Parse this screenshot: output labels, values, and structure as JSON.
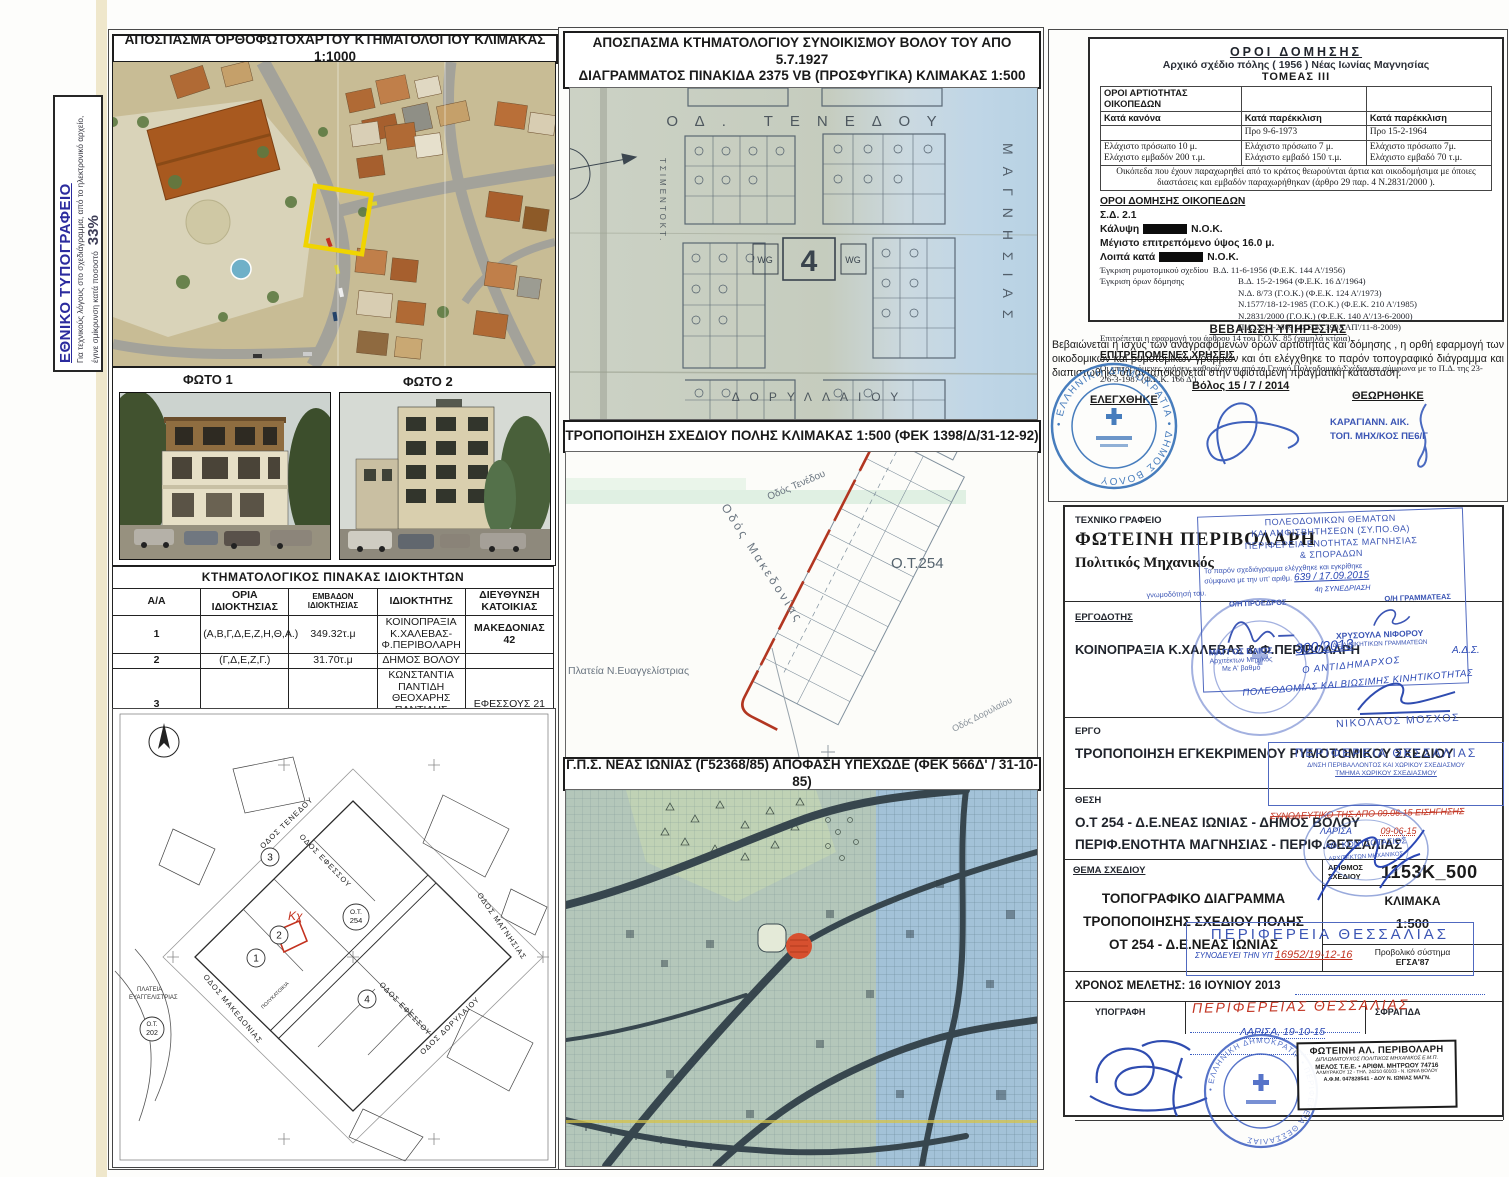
{
  "note_box": {
    "title": "ΕΘΝΙΚΟ ΤΥΠΟΓΡΑΦΕΙΟ",
    "body": "Για τεχνικούς λόγους στο σχεδιάγραμμα, από το ηλεκτρονικό αρχείο, έγινε σμίκρυνση κατά ποσοστό",
    "percent": "33%"
  },
  "ortho": {
    "title": "ΑΠΟΣΠΑΣΜΑ ΟΡΘΟΦΩΤΟΧΑΡΤΟΥ ΚΤΗΜΑΤΟΛΟΓΙΟΥ ΚΛΙΜΑΚΑΣ 1:1000"
  },
  "photos": {
    "label1": "ΦΩΤΟ 1",
    "label2": "ΦΩΤΟ 2"
  },
  "owners_table": {
    "title": "ΚΤΗΜΑΤΟΛΟΓΙΚΟΣ ΠΙΝΑΚΑΣ ΙΔΙΟΚΤΗΤΩΝ",
    "headers": [
      "Α/Α",
      "ΟΡΙΑ ΙΔΙΟΚΤΗΣΙΑΣ",
      "ΕΜΒΑΔΟΝ ΙΔΙΟΚΤΗΣΙΑΣ",
      "ΙΔΙΟΚΤΗΤΗΣ",
      "ΔΙΕΥΘΥΝΣΗ ΚΑΤΟΙΚΙΑΣ"
    ],
    "rows": [
      {
        "aa": "1",
        "oria": "(Α,Β,Γ,Δ,Ε,Ζ,Η,Θ,Α.)",
        "emvadon": "349.32τ.μ",
        "owner1": "ΚΟΙΝΟΠΡΑΞΙΑ Κ.ΧΑΛΕΒΑΣ-Φ.ΠΕΡΙΒΟΛΑΡΗ",
        "address": "ΜΑΚΕΔΟΝΙΑΣ 42"
      },
      {
        "aa": "2",
        "oria": "(Γ,Δ,Ε,Ζ,Γ.)",
        "emvadon": "31.70τ.μ",
        "owner1": "ΔΗΜΟΣ ΒΟΛΟΥ",
        "address": ""
      },
      {
        "aa": "3",
        "oria": "",
        "emvadon": "",
        "owner1": "ΚΩΝΣΤΑΝΤΙΑ ΠΑΝΤΙΔΗ",
        "owner2": "ΘΕΟΧΑΡΗΣ ΠΑΝΤΙΔΗΣ",
        "owner3": "ΑΠΟΣΤΟΛΟΣ ΠΑΝΤΙΔΗΣ",
        "address": "ΕΦΕΣΣΟΥΣ 21"
      },
      {
        "aa": "4",
        "oria": "",
        "emvadon": "",
        "owner1": "ΚΩΝΣΤΑΝΤΙΝΟΣ ΝΤΟΝΤΟΣ",
        "address": "ΕΦΕΣΣΟΥ 15"
      }
    ]
  },
  "map1927": {
    "title_line1": "ΑΠΟΣΠΑΣΜΑ ΚΤΗΜΑΤΟΛΟΓΙΟΥ ΣΥΝΟΙΚΙΣΜΟΥ ΒΟΛΟΥ ΤΟΥ ΑΠΟ 5.7.1927",
    "title_line2": "ΔΙΑΓΡΑΜΜΑΤΟΣ  ΠΙΝΑΚΙΔΑ 2375 VB (ΠΡΟΣΦΥΓΙΚΑ) ΚΛΙΜΑΚΑΣ 1:500",
    "street_top": "ΟΔ. ΤΕΝΕΔΟΥ",
    "street_bottom": "ΔΟΡΥΛΛΑΙΟΥ",
    "street_left": "ΤΣΙΜΕΝΤΟΚΤ.",
    "street_right": "ΜΑΓΝΗΣΙΑΣ",
    "block_number": "4",
    "wg_left": "WG",
    "wg_right": "WG"
  },
  "trop_map": {
    "title": "ΤΡΟΠΟΠΟΙΗΣΗ ΣΧΕΔΙΟΥ ΠΟΛΗΣ ΚΛΙΜΑΚΑΣ 1:500 (ΦΕΚ 1398/Δ/31-12-92)",
    "ot_label": "Ο.Τ.254",
    "street_makedonias": "Οδός Μακεδονίας",
    "street_tenedou": "Οδός Τενέδου",
    "street_dorylaiou": "Οδός Δορυλαίου",
    "plateia": "Πλατεία Ν.Ευαγγελίστριας"
  },
  "gps_map": {
    "title": "Γ.Π.Σ. ΝΕΑΣ ΙΩΝΙΑΣ (Γ52368/85) ΑΠΟΦΑΣΗ ΥΠΕΧΩΔΕ (ΦΕΚ 566Δ' / 31-10-85)"
  },
  "site_plan": {
    "ot_center_l1": "Ο.Τ.",
    "ot_center_l2": "254",
    "ot_left_l1": "Ο.Τ.",
    "ot_left_l2": "202",
    "kx": "Κχ",
    "parcel1": "1",
    "parcel2": "2",
    "parcel3": "3",
    "parcel4": "4",
    "street_tenedou": "ΟΔΟΣ ΤΕΝΕΔΟΥ",
    "street_makedonias": "ΟΔΟΣ ΜΑΚΕΔΟΝΙΑΣ",
    "street_efessou": "ΟΔΟΣ ΕΦΕΣΣΟΥ",
    "street_efessou2": "ΟΔΟΣ ΕΦΕΣΣΟΥ",
    "street_dorylaiou": "ΟΔΟΣ ΔΟΡΥΛΑΙΟΥ",
    "street_magnisias": "ΟΔΟΣ ΜΑΓΝΗΣΙΑΣ",
    "polykatoikia": "ΠΟΛΥΚΑΤΟΙΚΙΑ",
    "plateia_l1": "ΠΛΑΤΕΙΑ",
    "plateia_l2": "ΕΥΑΓΓΕΛΙΣΤΡΙΑΣ"
  },
  "oroi": {
    "title": "ΟΡΟΙ  ΔΟΜΗΣΗΣ",
    "subtitle": "Αρχικό σχέδιο πόλης  ( 1956 )  Νέας Ιωνίας Μαγνησίας",
    "tomeas": "ΤΟΜΕΑΣ  III",
    "artiotita_header": "ΟΡΟΙ ΑΡΤΙΟΤΗΤΑΣ ΟΙΚΟΠΕΔΩΝ",
    "col_kanona": "Κατά κανόνα",
    "col_parekklisi1": "Κατά παρέκκλιση",
    "col_parekklisi2": "Κατά παρέκκλιση",
    "pro1": "Προ 9-6-1973",
    "pro2": "Προ 15-2-1964",
    "kanona_line1": "Ελάχιστο πρόσωπο  10 μ.",
    "kanona_line2": "Ελάχιστο εμβαδόν  200 τ.μ.",
    "par1_line1": "Ελάχιστο πρόσωπο 7 μ.",
    "par1_line2": "Ελάχιστο εμβαδό  150 τ.μ.",
    "par2_line1": "Ελάχιστο πρόσωπο  7μ.",
    "par2_line2": "Ελάχιστο εμβαδό 70  τ.μ.",
    "note": "Οικόπεδα που έχουν παραχωρηθεί από το κράτος θεωρούνται άρτια και οικοδομήσιμα με όποιες διαστάσεις  και  εμβαδόν  παραχωρήθηκαν  (άρθρο 29 παρ. 4 Ν.2831/2000 ).",
    "section2": "ΟΡΟΙ  ΔΟΜΗΣΗΣ ΟΙΚΟΠΕΔΩΝ",
    "sd": "Σ.Δ.    2.1",
    "kalypsi_label": "Κάλυψη",
    "kalypsi_suffix": "Ν.Ο.Κ.",
    "ypsos": "Μέγιστο επιτρεπόμενο ύψος  16.0 μ.",
    "loipa_label": "Λοιπά κατά",
    "loipa_suffix": "Ν.Ο.Κ.",
    "egkrisi1_label": "Έγκριση ρυμοτομικού σχεδίου",
    "egkrisi1_value": "Β.Δ. 11-6-1956    (Φ.Ε.Κ. 144 Α'/1956)",
    "egkrisi2_label": "Έγκριση όρων δόμησης",
    "egkrisi2_values": [
      "Β.Δ. 15-2-1964    (Φ.Ε.Κ.   16 Δ'/1964)",
      "Ν.Δ. 8/73 (Γ.Ο.Κ.)  (Φ.Ε.Κ. 124 Α'/1973)",
      "Ν.1577/18-12-1985 (Γ.Ο.Κ.)  (Φ.Ε.Κ. 210 Α'/1985)",
      "Ν.2831/2000 (Γ.Ο.Κ.)  (Φ.Ε.Κ. 140 Α'/13-6-2000)",
      "Π.Δ. 22-7-2009  (Φ.Ε.Κ. 390ΑΑΠ'/11-8-2009)"
    ],
    "note2": "Επιτρέπεται η εφαρμογή του άρθρου 14 του Γ.Ο.Κ. 85 (χαμηλά κτίρια)",
    "section3": "ΕΠΙΤΡΕΠΟΜΕΝΕΣ ΧΡΗΣΕΙΣ",
    "uses": "Οι επιτρεπόμενες χρήσεις καθορίζονται από το Γενικό Πολεοδομικό Σχέδιο και σύμφωνα με το Π.Δ. της 23-2/6-3-1987 (Φ.Ε.Κ. 166 Δ')."
  },
  "bebaiosi": {
    "title": "ΒΕΒΑΙΩΣΗ ΥΠΗΡΕΣΙΑΣ",
    "body": "Βεβαιώνεται η ισχύς των αναγραφόμενων όρων αρτιότητας και δόμησης , η ορθή εφαρμογή των οικοδομικών και ρυμοτομικών γραμμών και ότι ελέγχθηκε το παρόν τοπογραφικό διάγραμμα και διαπιστώθηκε ότι ανταποκρίνεται στην υφιστάμενη πραγματική κατάσταση.",
    "place_date": "Βόλος 15 / 7 / 2014",
    "checked": "ΕΛΕΓΧΘΗΚΕ",
    "approved": "ΘΕΩΡΗΘΗΚΕ",
    "approver_line1": "ΚΑΡΑΓΙΑΝΝ.  ΑΙΚ.",
    "approver_line2": "ΤΟΠ. ΜΗΧ/ΚΟΣ ΠΕ6/Γ",
    "dimos_stamp_ring": "• ΕΛΛΗΝΙΚΗ ΔΗΜΟΚΡΑΤΙΑ • ΔΗΜΟΣ ΒΟΛΟΥ"
  },
  "title_block": {
    "office_label": "ΤΕΧΝΙΚΟ  ΓΡΑΦΕΙΟ",
    "office_name": "ΦΩΤΕΙΝΗ ΠΕΡΙΒΟΛΑΡΗ",
    "office_role": "Πολιτικός Μηχανικός",
    "ergodotis_label": "ΕΡΓΟΔΟΤΗΣ",
    "ergodotis": "ΚΟΙΝΟΠΡΑΞΙΑ Κ.ΧΑΛΕΒΑΣ & Φ.ΠΕΡΙΒΟΛΑΡΗ",
    "ergo_label": "ΕΡΓΟ",
    "ergo": "ΤΡΟΠΟΠΟΙΗΣΗ ΕΓΚΕΚΡΙΜΕΝΟΥ ΡΥΜΟΤΟΜΙΚΟΥ ΣΧΕΔΙΟΥ",
    "thesi_label": "ΘΕΣΗ",
    "thesi_line1": "Ο.Τ 254 - Δ.Ε.ΝΕΑΣ ΙΩΝΙΑΣ - ΔΗΜΟΣ ΒΟΛΟΥ",
    "thesi_line2": "ΠΕΡΙΦ.ΕΝΟΤΗΤΑ ΜΑΓΝΗΣΙΑΣ - ΠΕΡΙΦ.ΘΕΣΣΑΛΙΑΣ",
    "thema_label": "ΘΕΜΑ ΣΧΕΔΙΟΥ",
    "thema_line1": "ΤΟΠΟΓΡΑΦΙΚΟ ΔΙΑΓΡΑΜΜΑ",
    "thema_line2": "ΤΡΟΠΟΠΟΙΗΣΗΣ ΣΧΕΔΙΟΥ ΠΟΛΗΣ",
    "thema_line3": "ΟΤ 254 - Δ.Ε.ΝΕΑΣ ΙΩΝΙΑΣ",
    "arithmos_label": "ΑΡΙΘΜΟΣ ΣΧΕΔΙΟΥ",
    "arithmos": "1153Κ_500",
    "klimaka_label": "ΚΛΙΜΑΚΑ",
    "klimaka": "1:500",
    "provoliko_label": "Προβολικό σύστημα",
    "provoliko": "ΕΓΣΑ'87",
    "xronos": "ΧΡΟΝΟΣ ΜΕΛΕΤΗΣ: 16 ΙΟΥΝΙΟΥ 2013",
    "ypografi_label": "ΥΠΟΓΡΑΦΗ",
    "sfragida_label": "ΣΦΡΑΓΙΔΑ"
  },
  "stamps": {
    "sypotha": {
      "line1": "ΠΟΛΕΟΔΟΜΙΚΩΝ ΘΕΜΑΤΩΝ",
      "line2": "ΚΑΙ ΑΜΦΙΣΒΗΤΗΣΕΩΝ (ΣΥ.ΠΟ.ΘΑ)",
      "line3": "ΠΕΡΙΦΕΡΕΙΑ ΕΝΟΤΗΤΑΣ ΜΑΓΝΗΣΙΑΣ",
      "line4": "& ΣΠΟΡΑΔΩΝ",
      "body1": "Το παρόν σχεδιάγραμμα ελέγχθηκε και εγκρίθηκε",
      "body2": "σύμφωνα με την υπ' αριθμ.",
      "num": "639 / 17.09.2015",
      "session": "4η ΣΥΝΕΔΡΙΑΣΗ",
      "body3": "γνωμοδότησή του.",
      "proedros_label": "Ο/Η ΠΡΟΕΔΡΟΣ",
      "grammateas_label": "Ο/Η ΓΡΑΜΜΑΤΕΑΣ",
      "proedros_name": "ΜΑΓΓΟΣ ΒΑΙΟΣ",
      "proedros_role1": "Αρχιτέκτων Μηχ/κός",
      "proedros_role2": "Με Α' βαθμό",
      "grammateas_name": "ΧΡΥΣΟΥΛΑ ΝΙΦΟΡΟΥ",
      "grammateas_role": "ΔΕ ΔΙΟΙΚΗΤΙΚΩΝ ΓΡΑΜΜΑΤΕΩΝ"
    },
    "handwritten": {
      "protocol": "300/2013",
      "antidimarxos1": "Ο ΑΝΤΙΔΗΜΑΡΧΟΣ",
      "antidimarxos2": "ΠΟΛΕΟΔΟΜΙΑΣ ΚΑΙ ΒΙΩΣΙΜΗΣ ΚΙΝΗΤΙΚΟΤΗΤΑΣ",
      "ads": "Α.Δ.Σ.",
      "moschos": "ΝΙΚΟΛΑΟΣ ΜΟΣΧΟΣ"
    },
    "perifereia1": {
      "line1": "ΠΕΡΙΦΕΡΕΙΑ  ΘΕΣΣΑΛΙΑΣ",
      "line2": "Δ/ΝΣΗ ΠΕΡΙΒΑΛΛΟΝΤΟΣ ΚΑΙ ΧΩΡΙΚΟΥ ΣΧΕΔΙΑΣΜΟΥ",
      "line3": "ΤΜΗΜΑ ΧΩΡΙΚΟΥ ΣΧΕΔΙΑΣΜΟΥ",
      "red_note": "ΣΥΝΟΔΕΥΤΙΚΟ ΤΗΣ ΑΠΟ 09.06.15 ΕΙΣΗΓΗΣΗΣ",
      "larisa_label": "ΛΑΡΙΣΑ",
      "red_date": "09-06-15"
    },
    "kontsotasios": {
      "name": "ΑΘ. ΚΟΝΤΣΟΤΑΣΙΟΣ",
      "role": "ΑΡΧΙΤΕΚΤΩΝ ΜΗΧΑΝΙΚΟΣ"
    },
    "perifereia2": {
      "title": "ΠΕΡΙΦΕΡΕΙΑ  ΘΕΣΣΑΛΙΑΣ",
      "blue_note": "ΣΥΝΟΔΕΥΕΙ ΤΗΝ ΥΠ",
      "red_num": "16952/19-12-16"
    },
    "red_script": "ΠΕΡΙΦΕΡΕΙΑΣ  ΘΕΣΣΑΛΙΑΣ",
    "larisa_date": "ΛΑΡΙΣΑ, 19-10-15",
    "round_stamp_ring": "• ΕΛΛΗΝΙΚΗ ΔΗΜΟΚΡΑΤΙΑ • ΠΕΡΙΦΕΡΕΙΑ ΘΕΣΣΑΛΙΑΣ",
    "engineer_box": {
      "name": "ΦΩΤΕΙΝΗ ΑΛ. ΠΕΡΙΒΟΛΑΡΗ",
      "line2": "ΔΙΠΛΩΜΑΤΟΥΧΟΣ ΠΟΛΙΤΙΚΟΣ ΜΗΧΑΝΙΚΟΣ Ε.Μ.Π.",
      "line3": "ΜΕΛΟΣ Τ.Ε.Ε. • ΑΡΙΘΜ. ΜΗΤΡΩΟΥ 74716",
      "line4": "ΑΛΜΥΡΑΚΟΥ 12 - ΤΗΛ. 24210 60103 - Ν. ΙΩΝΙΑ ΒΟΛΟΥ",
      "line5": "Α.Φ.Μ. 047828541 - ΔΟΥ Ν. ΙΩΝΙΑΣ ΜΑΓΝ."
    }
  }
}
